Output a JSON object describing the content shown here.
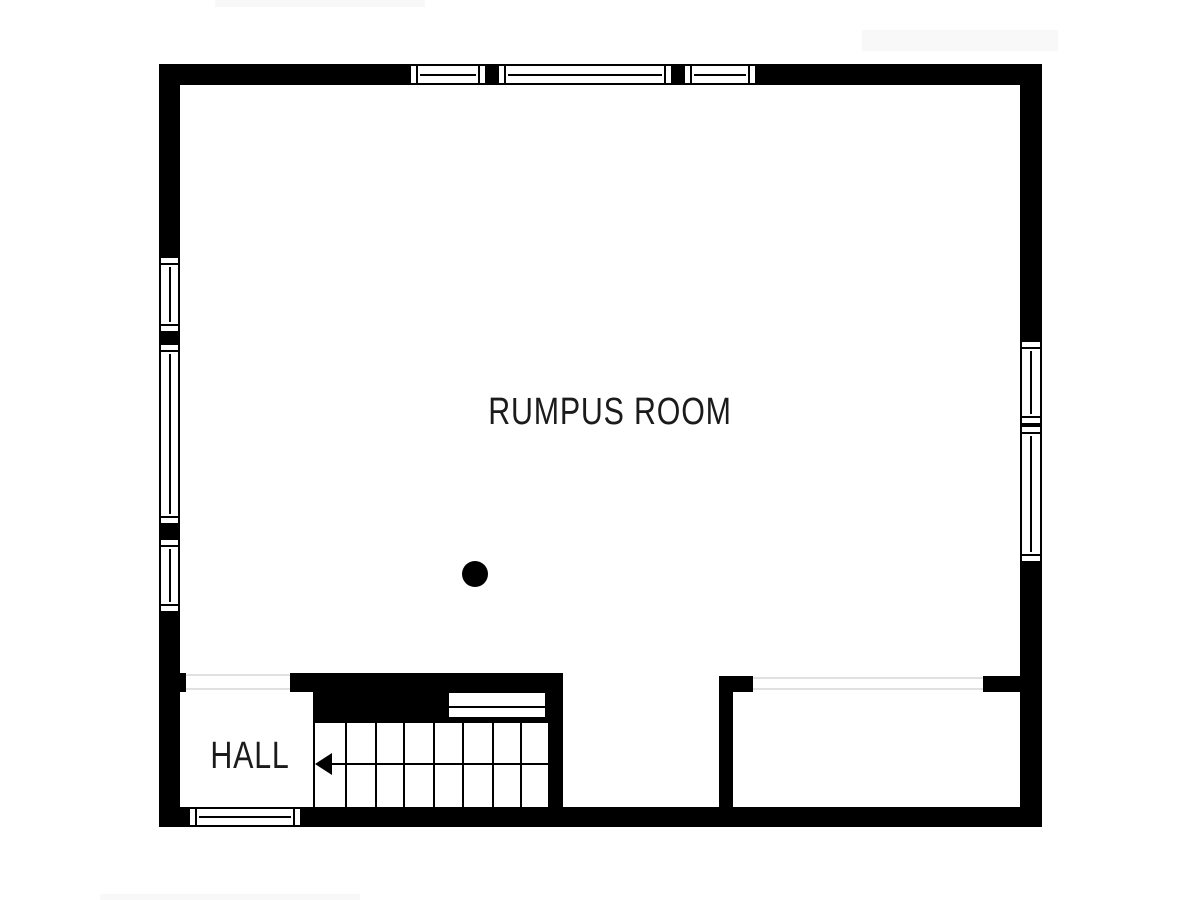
{
  "floor_plan": {
    "rooms": [
      {
        "id": "rumpus-room",
        "label": "RUMPUS ROOM"
      },
      {
        "id": "hall",
        "label": "HALL"
      }
    ],
    "stairs": {
      "tread_columns": 8,
      "arrow_direction": "left",
      "landing_steps": 2
    },
    "windows": {
      "top_wall": 3,
      "left_wall": 3,
      "right_wall": 2,
      "bottom_wall": 1
    },
    "features": {
      "column_dot": "round structural post in rumpus room"
    },
    "colors": {
      "wall": "#000000",
      "floor": "#ffffff",
      "opening_line": "#e0e0e0",
      "label_text": "#1b1b1b"
    }
  }
}
